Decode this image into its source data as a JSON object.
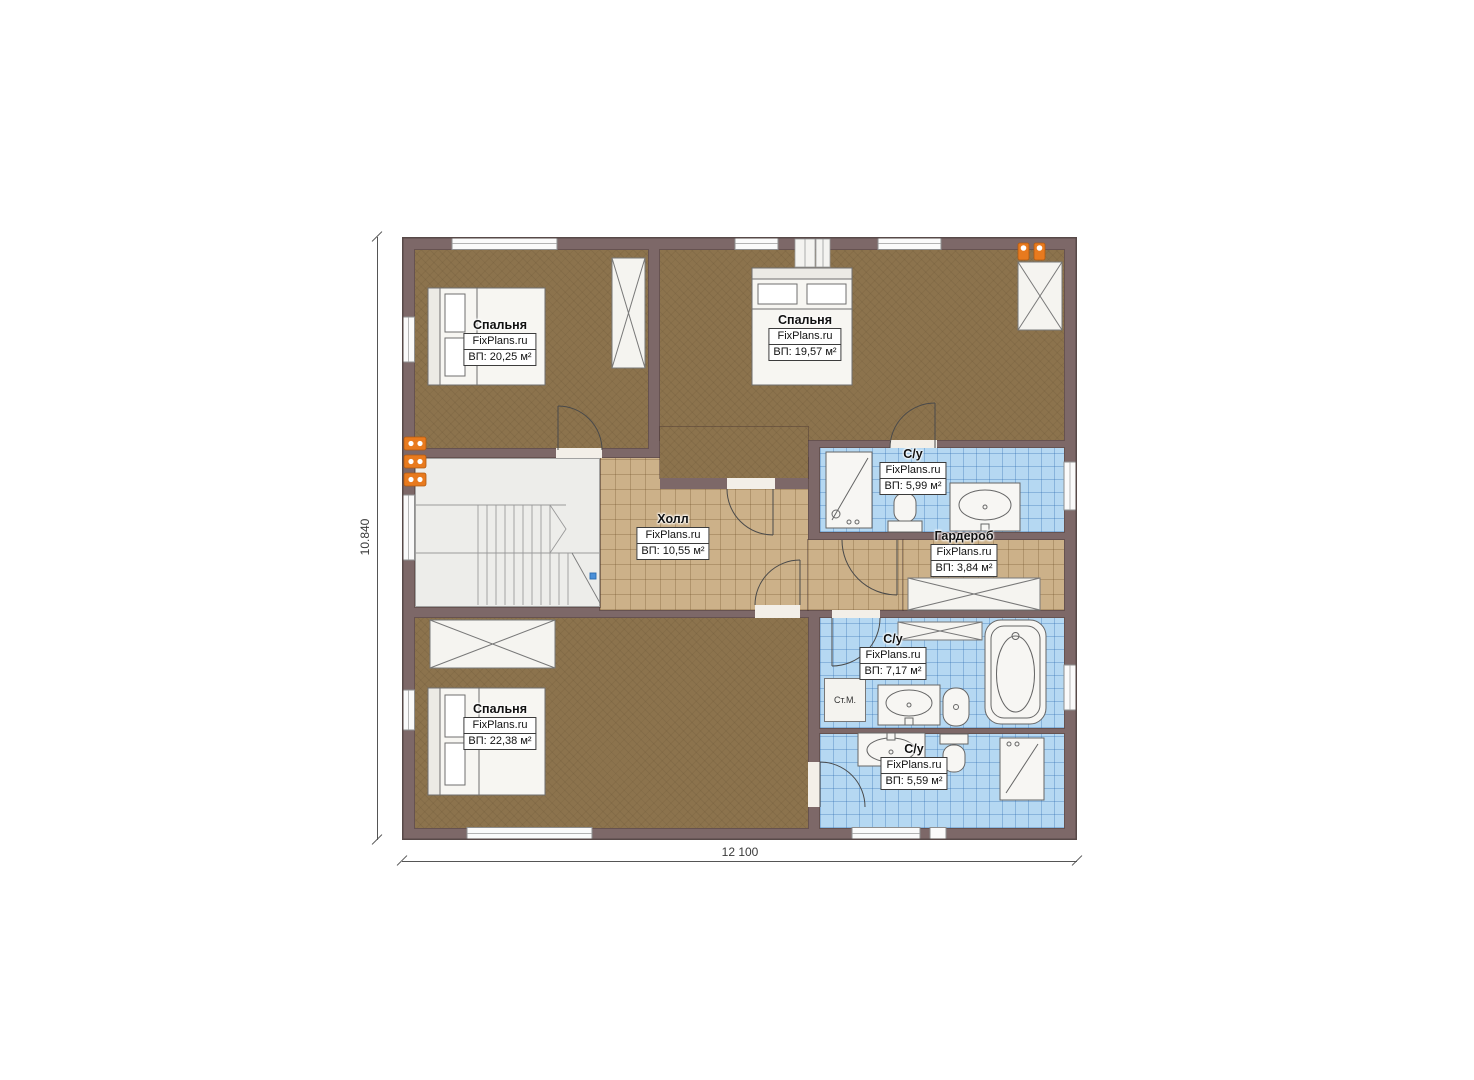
{
  "plan": {
    "site_watermark": "FixPlans.ru",
    "dimensions": {
      "height_label": "10.840",
      "width_label": "12 100"
    },
    "rooms": [
      {
        "key": "bedroom-1",
        "name": "Спальня",
        "brand": "FixPlans.ru",
        "area": "ВП: 20,25 м²"
      },
      {
        "key": "bedroom-2",
        "name": "Спальня",
        "brand": "FixPlans.ru",
        "area": "ВП: 19,57 м²"
      },
      {
        "key": "hall",
        "name": "Холл",
        "brand": "FixPlans.ru",
        "area": "ВП: 10,55 м²"
      },
      {
        "key": "bathroom-top",
        "name": "С/у",
        "brand": "FixPlans.ru",
        "area": "ВП: 5,99 м²"
      },
      {
        "key": "wardrobe-room",
        "name": "Гардероб",
        "brand": "FixPlans.ru",
        "area": "ВП: 3,84 м²"
      },
      {
        "key": "bathroom-middle",
        "name": "С/у",
        "brand": "FixPlans.ru",
        "area": "ВП: 7,17 м²"
      },
      {
        "key": "bathroom-bottom",
        "name": "С/у",
        "brand": "FixPlans.ru",
        "area": "ВП: 5,59 м²"
      },
      {
        "key": "bedroom-3",
        "name": "Спальня",
        "brand": "FixPlans.ru",
        "area": "ВП: 22,38 м²"
      }
    ],
    "fixtures": {
      "washing_machine_label": "Ст.М."
    },
    "colors": {
      "wall": "#7d6868",
      "bedroom_floor": "#8c734d",
      "tile_floor": "#ccb189",
      "bath_floor": "#b5d8f2",
      "flue": "#e87a1e"
    }
  }
}
